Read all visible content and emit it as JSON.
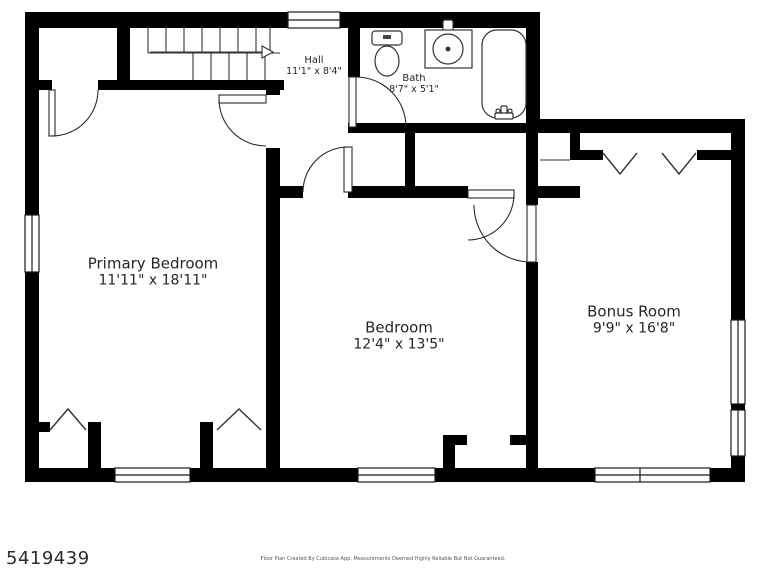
{
  "page": {
    "background": "#ffffff"
  },
  "floor_plan": {
    "type": "residential-upper-floor",
    "rooms": [
      {
        "id": "primary_bedroom",
        "name": "Primary Bedroom",
        "dimensions": "11'11\" x 18'11\""
      },
      {
        "id": "bedroom",
        "name": "Bedroom",
        "dimensions": "12'4\" x 13'5\""
      },
      {
        "id": "bonus_room",
        "name": "Bonus Room",
        "dimensions": "9'9\" x 16'8\""
      },
      {
        "id": "hall",
        "name": "Hall",
        "dimensions": "11'1\" x 8'4\""
      },
      {
        "id": "bath",
        "name": "Bath",
        "dimensions": "8'7\" x 5'1\""
      }
    ],
    "fixtures": [
      "staircase-with-direction-arrow",
      "toilet",
      "sink-vanity",
      "bathtub"
    ],
    "features": [
      "closets-with-chevron-doors",
      "windows",
      "door-swings"
    ],
    "colors": {
      "wall": "#000000",
      "floor": "#ffffff",
      "line": "#2a2a2a",
      "text": "#262626"
    }
  },
  "footer": {
    "listing_number": "5419439",
    "disclaimer": "Floor Plan Created By Cubicasa App. Measurements Deemed Highly Reliable But Not Guaranteed."
  }
}
